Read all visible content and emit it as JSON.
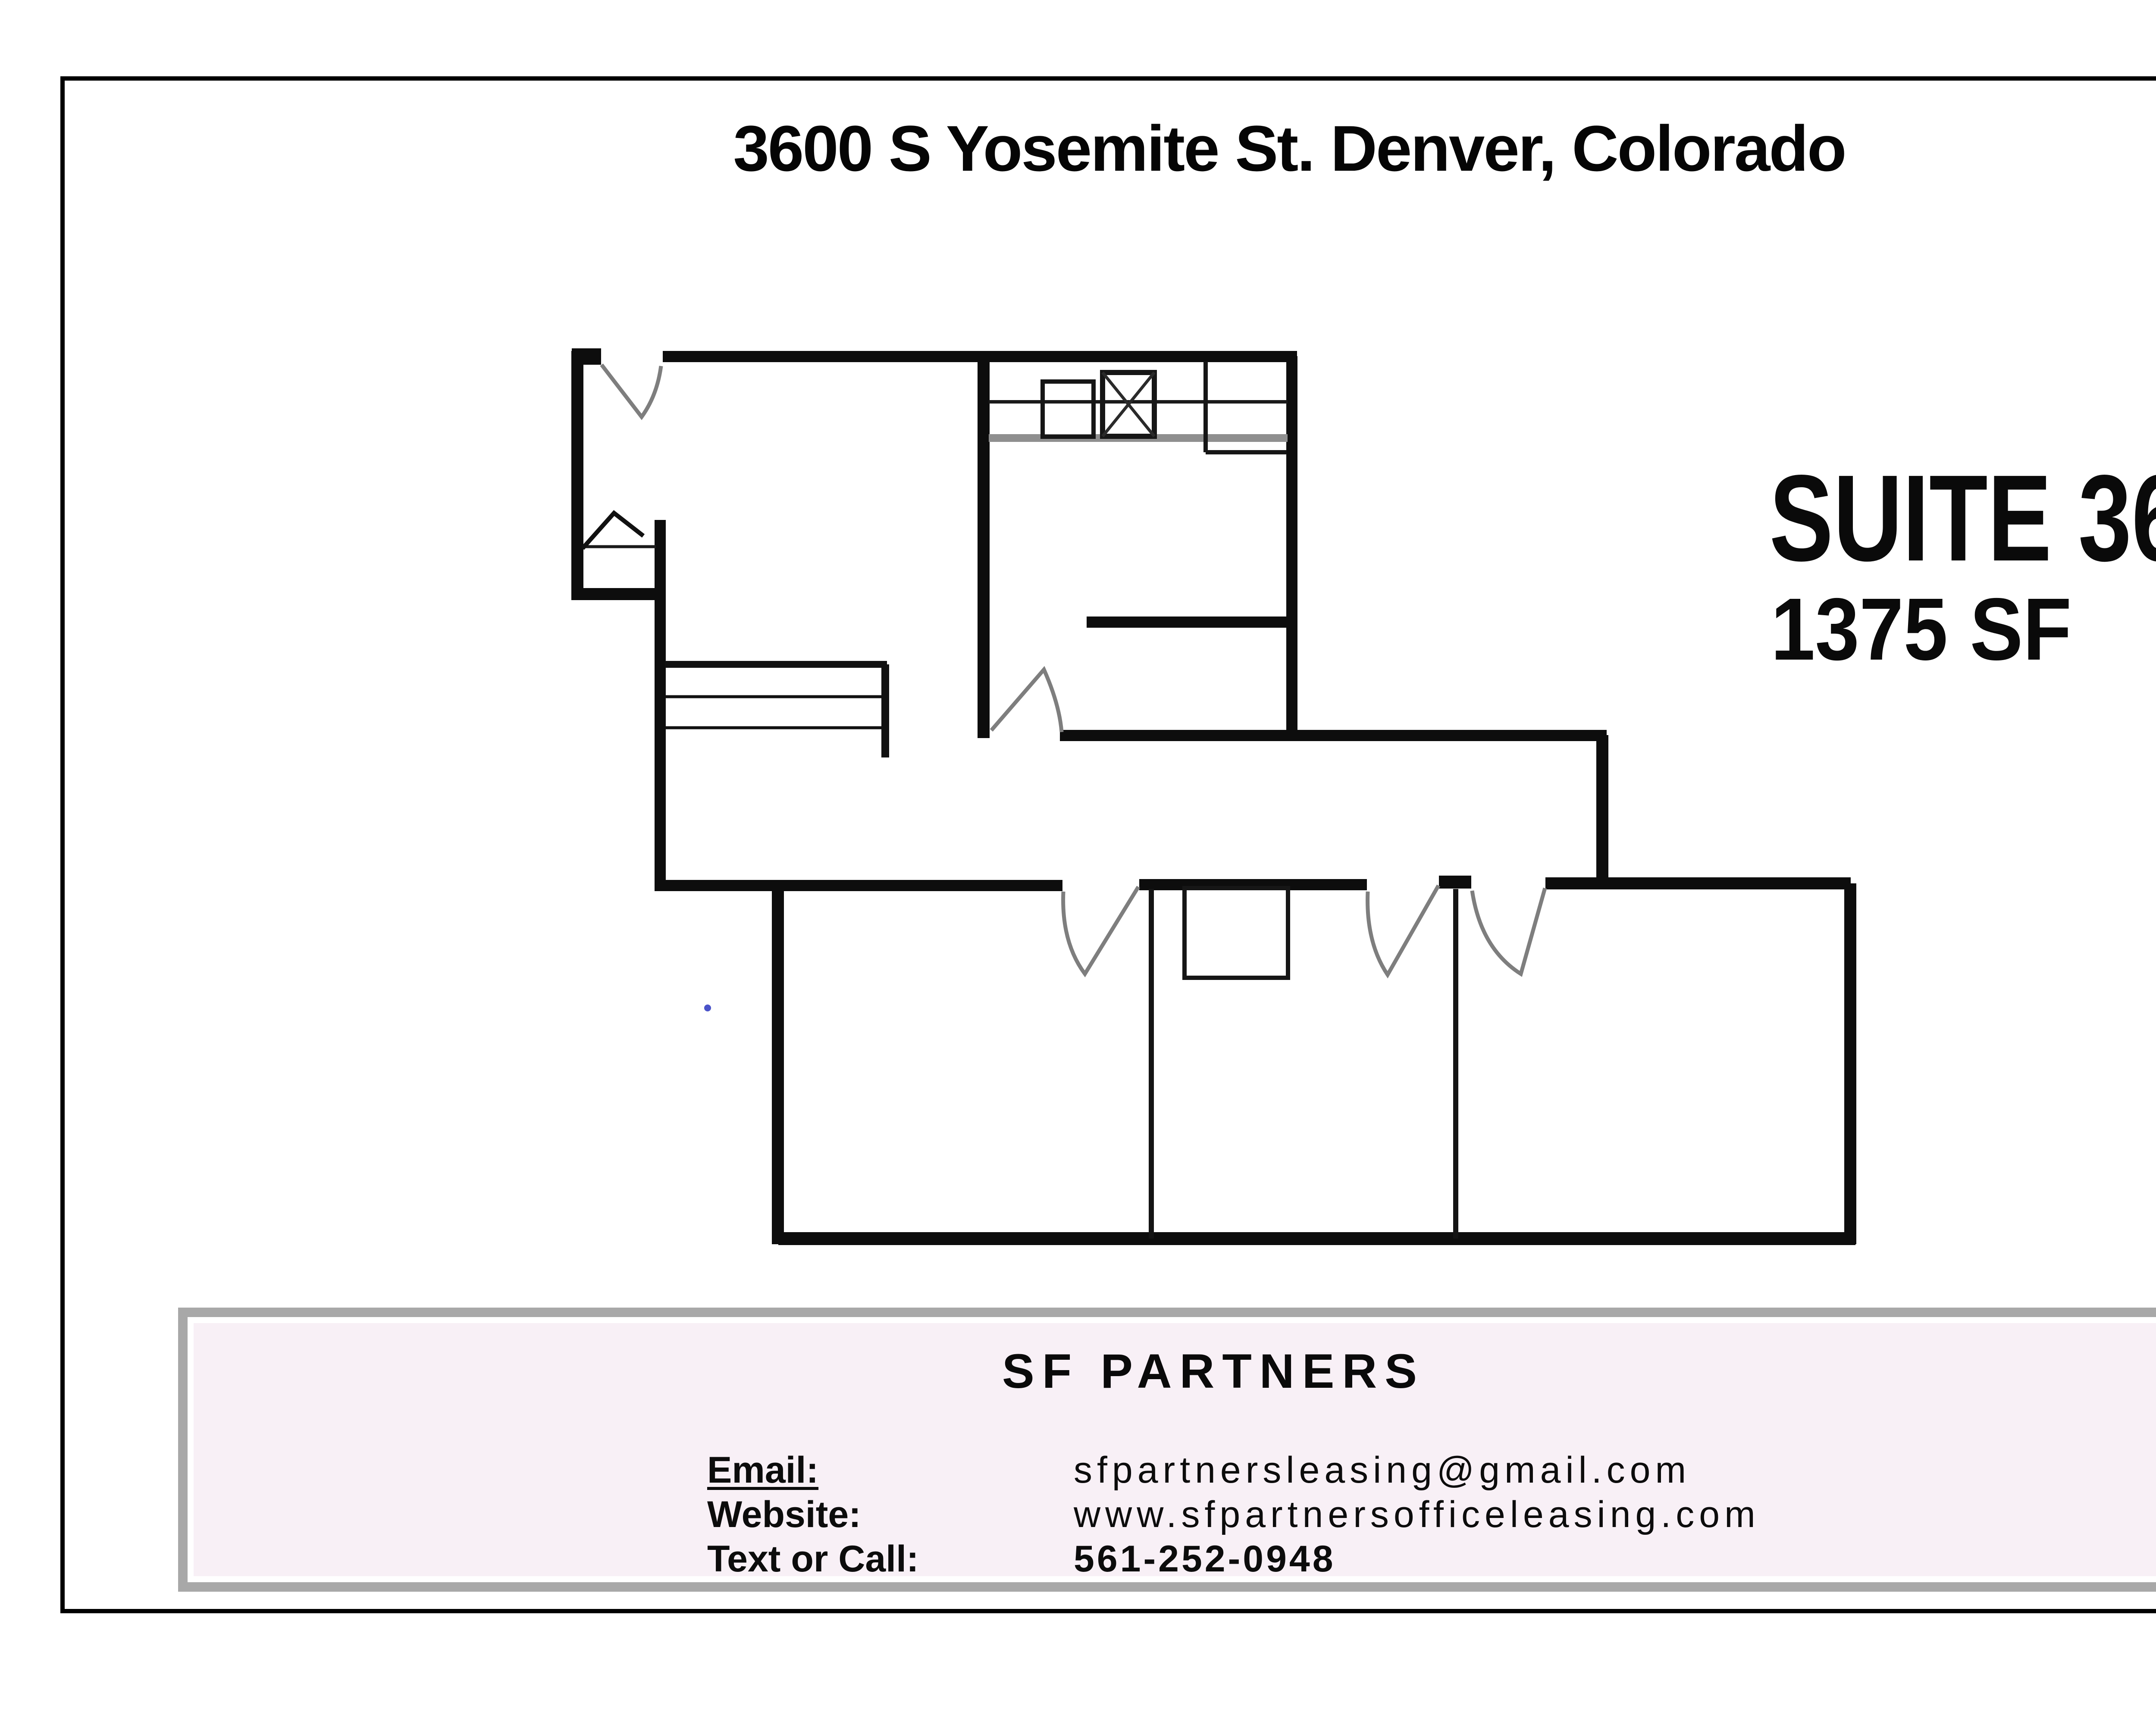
{
  "header": {
    "address": "3600 S Yosemite St. Denver, Colorado"
  },
  "suite": {
    "name": "SUITE 360",
    "area": "1375 SF"
  },
  "contact": {
    "brand": "SF PARTNERS",
    "rows": [
      {
        "label": "Email:",
        "value": "sfpartnersleasing@gmail.com"
      },
      {
        "label": "Website:",
        "value": "www.sfpartnersofficeleasing.com"
      },
      {
        "label": "Text or Call:",
        "value": "561-252-0948"
      }
    ]
  },
  "colors": {
    "wall": "#0d0d0d",
    "door_swing": "#7e7e7e",
    "counter_gray": "#8f8f8f",
    "contact_border": "#a8a8a8",
    "contact_background": "#f8f0f6",
    "page_border": "#000000",
    "speck_blue": "#2a35c0"
  }
}
